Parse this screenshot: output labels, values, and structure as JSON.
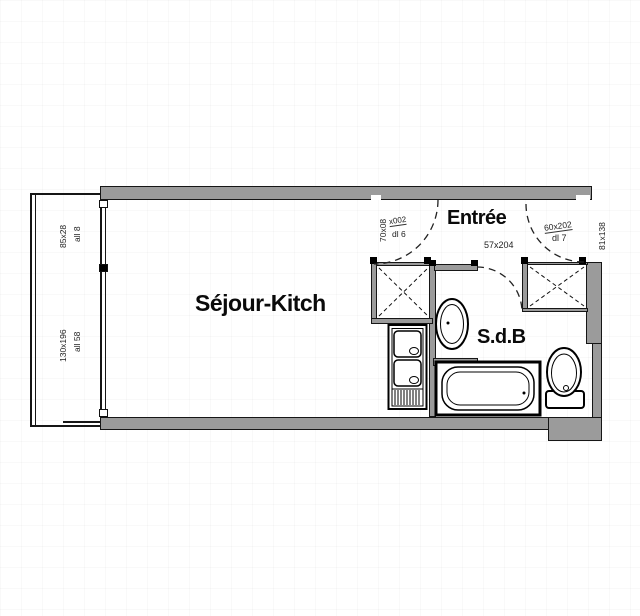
{
  "plan_title": "Studio floor plan",
  "rooms": {
    "sejour": "Séjour-Kitch",
    "entree": "Entrée",
    "sdb": "S.d.B"
  },
  "dimensions": {
    "entree_door": "57x204",
    "balcony_window_top": "85x28",
    "balcony_window_top_sill": "all 8",
    "balcony_window_bottom": "130x196",
    "balcony_window_bottom_sill": "all 58",
    "closet_left_dim": "70x08",
    "closet_left_code": "x002",
    "closet_left_sill": "dl 6",
    "closet_right_dim": "60x202",
    "closet_right_sill": "dl 7",
    "right_wall_dim": "81x138"
  },
  "colors": {
    "wall_fill": "#9b9b9b",
    "line": "#161616",
    "background": "#ffffff"
  }
}
